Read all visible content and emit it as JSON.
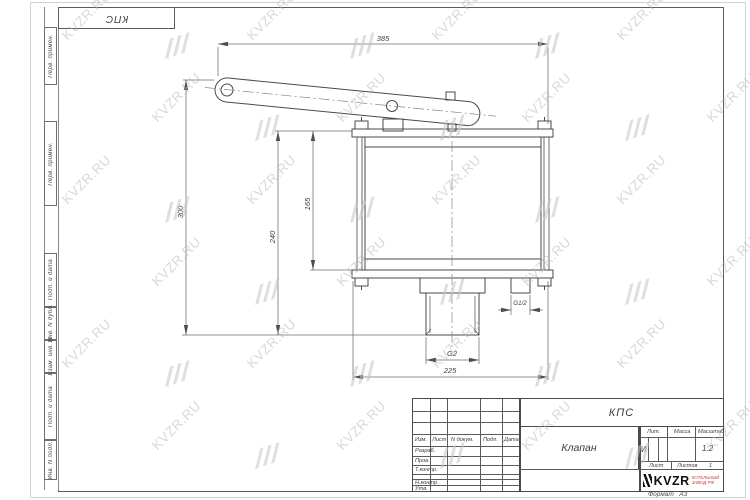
{
  "frame": {
    "corner_designation": "КПС",
    "margin_labels": [
      "Перв. примен.",
      "Перв. примен.",
      "Подп. и дата",
      "Инв. N дубл.",
      "Взам. инв. N",
      "Подп. и дата",
      "Инв. N подл."
    ]
  },
  "watermark": {
    "text": "KVZR.RU"
  },
  "drawing": {
    "dimensions": {
      "total_width": "385",
      "total_height": "300",
      "body_height": "240",
      "flange_height": "165",
      "outlet_thread": "G2",
      "flange_width": "225",
      "side_port_thread": "G1/2"
    }
  },
  "title_block": {
    "designation": "КПС",
    "part_name": "Клапан",
    "header_cols": [
      "Изм.",
      "Лист",
      "N докум.",
      "Подп.",
      "Дата"
    ],
    "sign_rows": [
      "Разраб.",
      "Пров.",
      "Т.контр.",
      "Н.контр.",
      "Утв."
    ],
    "lit_label": "Лит.",
    "lit_value": "И",
    "mass_label": "Масса",
    "scale_label": "Масштаб",
    "scale_value": "1:2",
    "sheet_label": "Лист",
    "sheets_label": "Листов",
    "sheets_value": "1",
    "logo_text": "KVZR",
    "company_line1": "КОТЕЛЬНЫЙ",
    "company_line2": "ЗАВОД РФ",
    "format_label": "Формат",
    "format_value": "А3"
  }
}
